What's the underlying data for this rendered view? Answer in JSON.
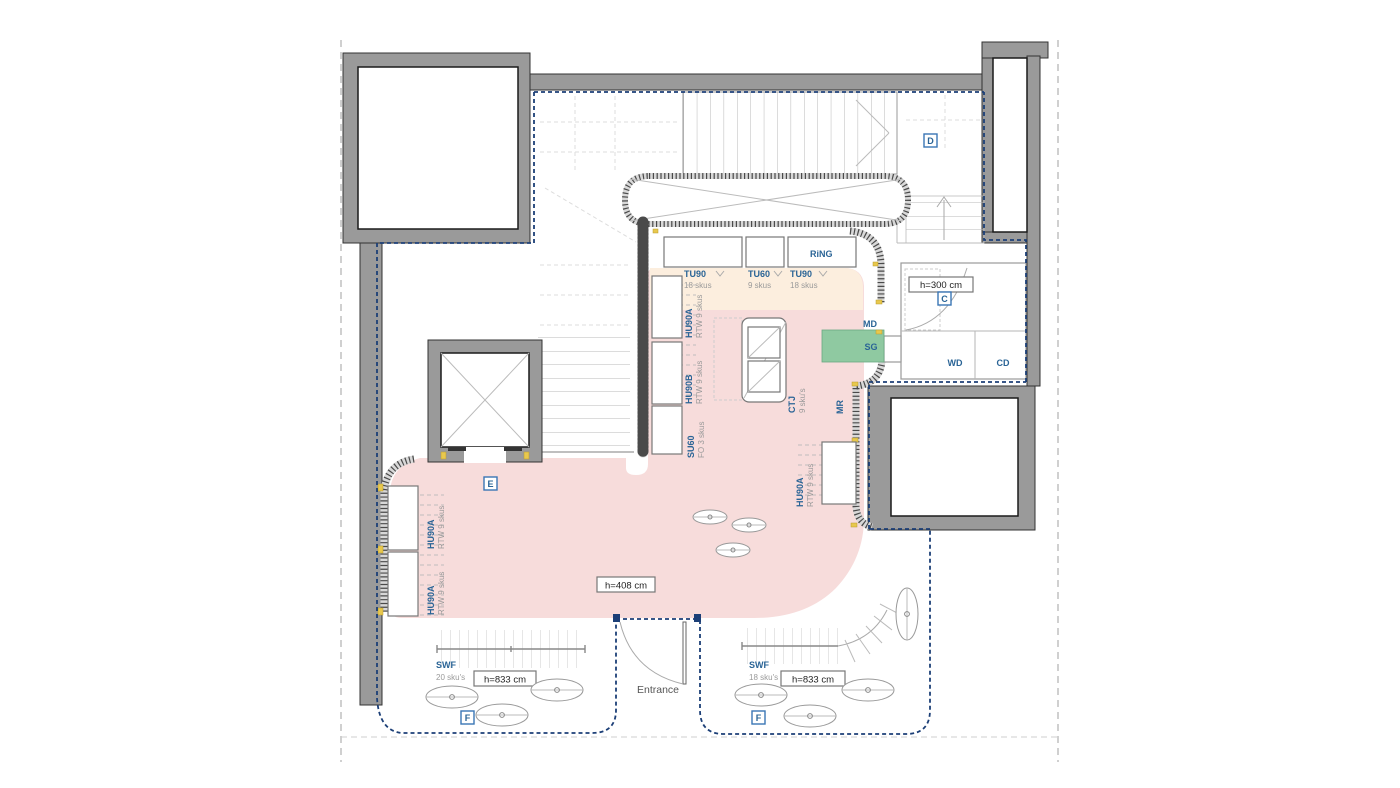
{
  "plan": {
    "zone_markers": {
      "d": "D",
      "c": "C",
      "e": "E",
      "f_left": "F",
      "f_right": "F"
    },
    "wall_units": {
      "tu90_left": {
        "name": "TU90",
        "count": "18 skus"
      },
      "tu60": {
        "name": "TU60",
        "count": "9 skus"
      },
      "tu90_right": {
        "name": "TU90",
        "count": "18 skus"
      },
      "ring": {
        "name": "RiNG"
      },
      "hu90a_back": {
        "name": "HU90A",
        "count": "RTW 9 skus"
      },
      "hu90b_back": {
        "name": "HU90B",
        "count": "RTW 9 skus"
      },
      "su60": {
        "name": "SU60",
        "count": "FO 3 skus"
      },
      "ctj_island": {
        "name": "CTJ",
        "count": "9 sku's"
      },
      "mr": {
        "name": "MR"
      },
      "md": {
        "name": "MD"
      },
      "sg": {
        "name": "SG"
      },
      "wd": {
        "name": "WD"
      },
      "cd": {
        "name": "CD"
      },
      "hu90a_right": {
        "name": "HU90A",
        "count": "RTW 9 skus"
      },
      "hu90a_left_upper": {
        "name": "HU90A",
        "count": "RTW 9 skus"
      },
      "hu90a_left_lower": {
        "name": "HU90A",
        "count": "RTW 9 skus"
      },
      "swf_left": {
        "name": "SWF",
        "count": "20 sku's"
      },
      "swf_right": {
        "name": "SWF",
        "count": "18 sku's"
      }
    },
    "ceiling_heights": {
      "room_c": "h=300 cm",
      "sales_floor": "h=408 cm",
      "window_left": "h=833 cm",
      "window_right": "h=833 cm"
    },
    "entrance_label": "Entrance",
    "colors": {
      "sales_floor_pink": "#f7dcdb",
      "display_zone_peach": "#fceede",
      "sg_green": "#8fc9a1",
      "wall_gray": "#9a9a9a",
      "lease_line_navy": "#1c3f77",
      "label_blue": "#2a6496",
      "site_line_gray": "#b0b0b0"
    }
  }
}
